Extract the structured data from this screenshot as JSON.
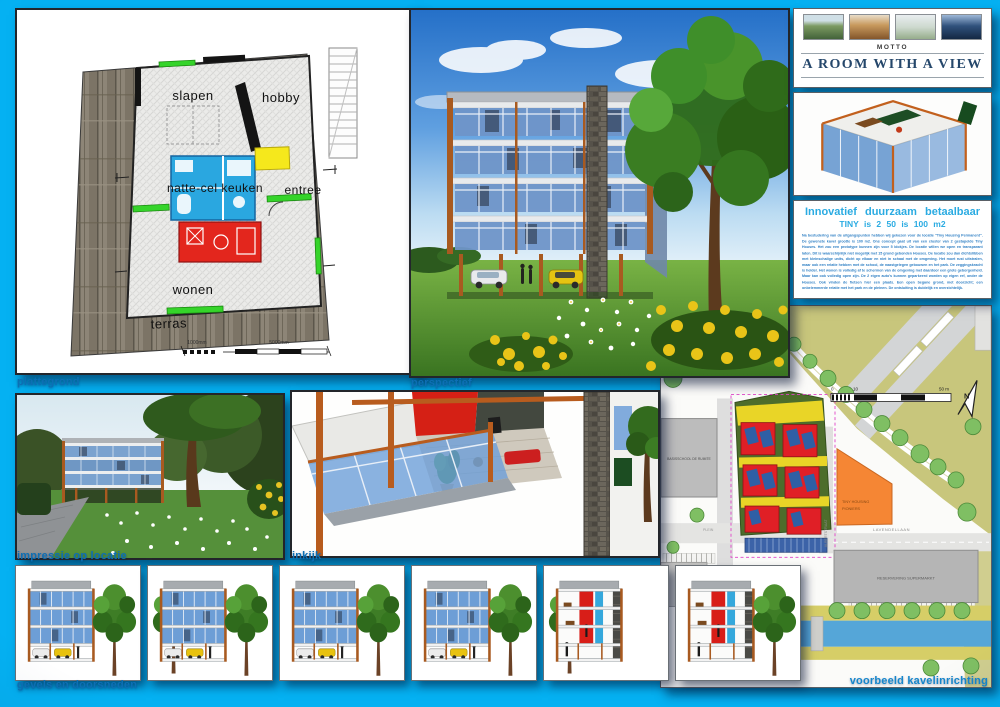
{
  "colors": {
    "background": "#05b1f2",
    "caption_blue": "#0d6fb4",
    "heading_cyan": "#2aabe2",
    "motto_navy": "#25476b",
    "accent_orange": "#b05c1e",
    "glass_blue": "#6d9ed6"
  },
  "captions": {
    "plattegrond": "plattegrond",
    "perspectief": "perspectief",
    "impressie": "impressie op locatie",
    "inkijk": "inkijk",
    "gevels": "gevels en doorsneden",
    "kavel": "voorbeeld kavelinrichting"
  },
  "plattegrond": {
    "rooms": {
      "slapen": "slapen",
      "hobby": "hobby",
      "natte_cel_keuken": "natte-cel keuken",
      "entree": "entree",
      "wonen": "wonen",
      "terras": "terras"
    },
    "scale": {
      "small": "1000mm",
      "large": "5000mm"
    }
  },
  "motto": {
    "kicker": "MOTTO",
    "title": "A ROOM WITH A VIEW",
    "photos": [
      "garden-terrace-view",
      "wood-interior-view",
      "light-room-view",
      "evening-city-view"
    ]
  },
  "concept": {
    "title": "Innovatief duurzaam betaalbaar",
    "subtitle": "TINY is 2 50 is 100 m2",
    "body": "Na bestudering van de uitgangspunten hebben wij gekozen voor de locatie \"Tiny Housing Permanent\". De gewenste kavel grootte is 100 m2. Ons concept gaat uit van een cluster van 2 gestapelde Tiny Houses. Het zou een prototype kunnen zijn voor 5 blokjes. De locatie willen we open en transparant laten. Dit is waarschijnlijk niet mogelijk met 15 grond gebonden Houses. De locatie zou dan dichtslibben met kleinschalige units, dicht op elkaar en niet in schaal met de omgeving. Het moet rust uitstralen, maar ook een relatie hebben met de school, de naastgelegen gebouwen en het park. De zeggingskracht is helder. Het wonen is volledig af te schermen van de omgeving met daardoor een grote geborgenheid. Maar kan ook volledig open zijn. De 2 eigen auto's kunnen geparkeerd worden op eigen erf, onder de Houses. Ook vinden de fietsen hier een plaats. Een open begane grond, met doorzicht; een onbelemmerde relatie met het park en de pleinen. De ontsluiting is duidelijk en overzichtelijk."
  },
  "siteplan": {
    "school": "BASISSCHOOL DE RUIMTE",
    "pioniers_line1": "TINY HOUSING",
    "pioniers_line2": "PIONIERS",
    "supermarkt": "RESERVERING SUPERMARKT",
    "street_lavendel": "LAVENDELLAAN",
    "street_albert": "ALBERTSTRAAT",
    "plein": "PLEIN",
    "north": "N",
    "scale_0": "0",
    "scale_10": "10",
    "scale_50": "50 m"
  },
  "gevels": {
    "panels": [
      {
        "variant": "elevation",
        "tree": "right"
      },
      {
        "variant": "elevation",
        "tree": "both"
      },
      {
        "variant": "elevation",
        "tree": "right"
      },
      {
        "variant": "elevation",
        "tree": "right"
      },
      {
        "variant": "section",
        "tree": "left"
      },
      {
        "variant": "section",
        "tree": "right"
      }
    ]
  }
}
